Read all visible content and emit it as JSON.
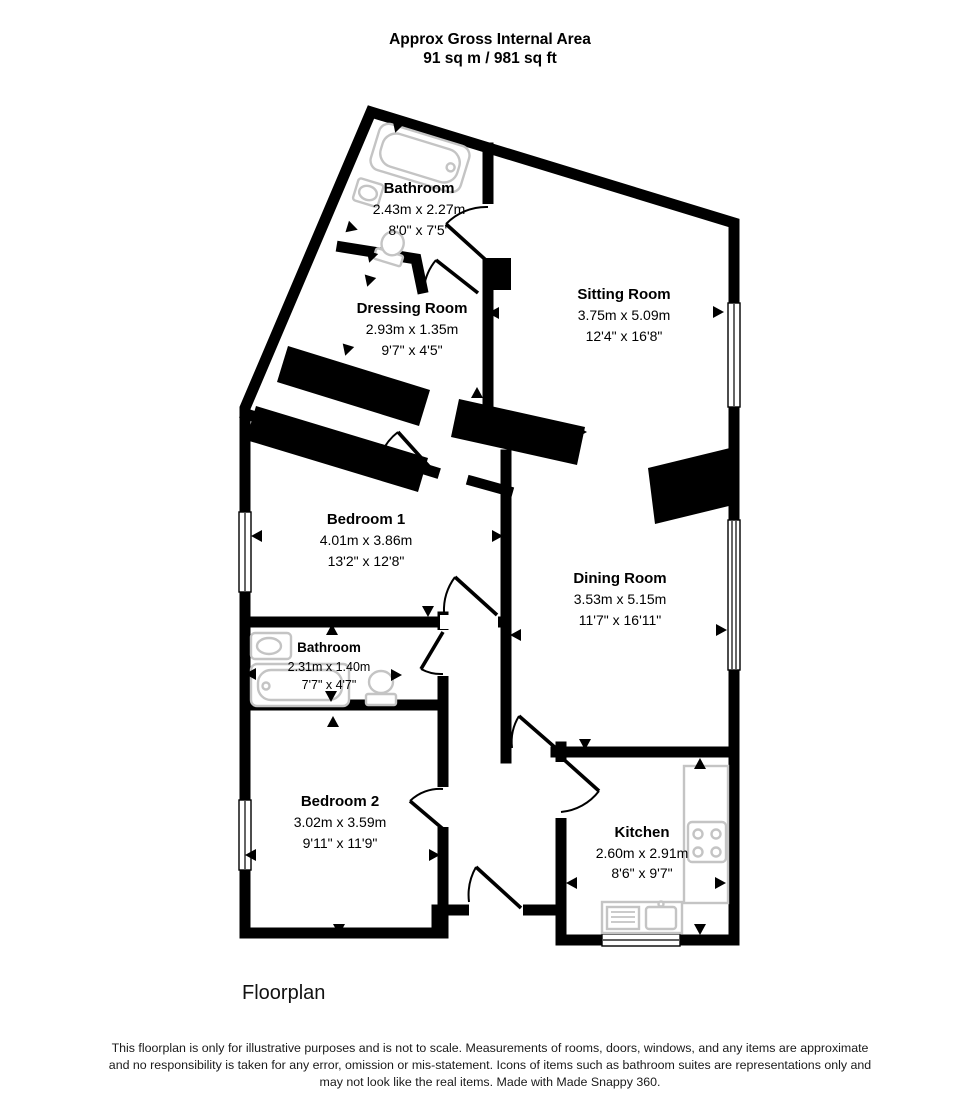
{
  "header": {
    "line1": "Approx Gross Internal Area",
    "line2": "91 sq m / 981 sq ft"
  },
  "rooms": [
    {
      "id": "bathroom-1",
      "name": "Bathroom",
      "metric": "2.43m x 2.27m",
      "imperial": "8'0\" x 7'5\""
    },
    {
      "id": "dressing-room",
      "name": "Dressing Room",
      "metric": "2.93m x 1.35m",
      "imperial": "9'7\" x 4'5\""
    },
    {
      "id": "sitting-room",
      "name": "Sitting Room",
      "metric": "3.75m x 5.09m",
      "imperial": "12'4\" x 16'8\""
    },
    {
      "id": "bedroom-1",
      "name": "Bedroom 1",
      "metric": "4.01m x 3.86m",
      "imperial": "13'2\" x 12'8\""
    },
    {
      "id": "dining-room",
      "name": "Dining Room",
      "metric": "3.53m x 5.15m",
      "imperial": "11'7\" x 16'11\""
    },
    {
      "id": "bathroom-2",
      "name": "Bathroom",
      "metric": "2.31m x 1.40m",
      "imperial": "7'7\" x 4'7\""
    },
    {
      "id": "bedroom-2",
      "name": "Bedroom 2",
      "metric": "3.02m x 3.59m",
      "imperial": "9'11\" x 11'9\""
    },
    {
      "id": "kitchen",
      "name": "Kitchen",
      "metric": "2.60m x 2.91m",
      "imperial": "8'6\" x 9'7\""
    }
  ],
  "footer": {
    "caption": "Floorplan",
    "disclaimer_line1": "This floorplan is only for illustrative purposes and is not to scale. Measurements of rooms, doors, windows, and any items are approximate",
    "disclaimer_line2": "and no responsibility is taken for any error, omission or mis-statement. Icons of items such as bathroom suites are representations only and",
    "disclaimer_line3": "may not look like the real items. Made with Made Snappy 360."
  },
  "colors": {
    "wall": "#000000",
    "fixture": "#c4c4c4",
    "background": "#ffffff"
  }
}
